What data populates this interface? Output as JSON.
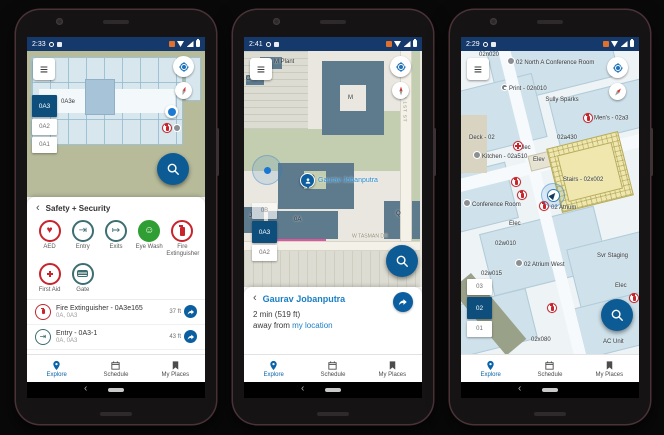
{
  "palette": {
    "status_bar": "#16396b",
    "accent_blue": "#0d5b94",
    "selected_floor_chip": "#0d4e7d",
    "link_blue": "#1b7fc4",
    "alert_red": "#c8242c",
    "safety_teal": "#3d6e72",
    "eye_wash_green": "#2f9e33",
    "building_blue_gray": "#5e7b8e",
    "map_olive": "#b7bb9a",
    "floorplan_blue": "#d8e7ee",
    "stairs_yellow": "#efe7ad",
    "nav_active": "#0a63a9",
    "nav_inactive": "#4c4c4c"
  },
  "ui": {
    "back_icon": "‹",
    "hamburger_icon": "≡"
  },
  "nav": {
    "items": [
      {
        "label": "Explore"
      },
      {
        "label": "Schedule"
      },
      {
        "label": "My Places"
      }
    ]
  },
  "phones": [
    {
      "status": {
        "time": "2:33"
      },
      "map": {
        "room_label": "0A3e",
        "floors": [
          {
            "label": "0A3",
            "selected": true
          },
          {
            "label": "0A2"
          },
          {
            "label": "0A1"
          }
        ]
      },
      "sheet": {
        "title": "Safety + Security",
        "categories": [
          {
            "label": "AED",
            "glyph": "♥"
          },
          {
            "label": "Entry",
            "glyph": "⇥"
          },
          {
            "label": "Exits",
            "glyph": "↦"
          },
          {
            "label": "Eye Wash",
            "glyph": "☺"
          },
          {
            "label": "Fire Extinguisher"
          },
          {
            "label": "First Aid"
          },
          {
            "label": "Gate"
          }
        ],
        "results": [
          {
            "title": "Fire Extinguisher - 0A3e165",
            "subtitle": "0A, 0A3",
            "distance": "37 ft"
          },
          {
            "title": "Entry - 0A3-1",
            "subtitle": "0A, 0A3",
            "distance": "43 ft",
            "glyph": "⇥"
          }
        ]
      }
    },
    {
      "status": {
        "time": "2:41"
      },
      "map": {
        "labels": [
          "M Plant",
          "O Plant",
          "M",
          "O",
          "0A",
          "Q",
          "J"
        ],
        "street_vertical": "N 1ST ST",
        "street_horizontal": "W TASMAN DR",
        "person_label": "Gaurav Jobanputra",
        "floors": [
          {
            "label": "0B"
          },
          {
            "label": "0A3",
            "selected": true
          },
          {
            "label": "0A2"
          }
        ]
      },
      "sheet": {
        "title": "Gaurav Jobanputra",
        "eta": "2 min (519 ft)",
        "away_prefix": "away from ",
        "location_link": "my location"
      }
    },
    {
      "status": {
        "time": "2:29"
      },
      "map": {
        "labels": [
          "02n020",
          "02 North A Conference Room",
          "Print - 02n010",
          "Sully Sparks",
          "Men's - 02a3",
          "Deck - 02",
          "Elec",
          "02a430",
          "Kitchen - 02a510",
          "Elev",
          "Stairs - 02x002",
          "02 Atrium",
          "Conference Room",
          "Elec",
          "02w010",
          "02 Atrium West",
          "Svr Staging",
          "02w015",
          "02x080",
          "AC Unit",
          "Elec"
        ],
        "floors": [
          {
            "label": "03"
          },
          {
            "label": "02",
            "selected": true
          },
          {
            "label": "01"
          }
        ]
      }
    }
  ]
}
